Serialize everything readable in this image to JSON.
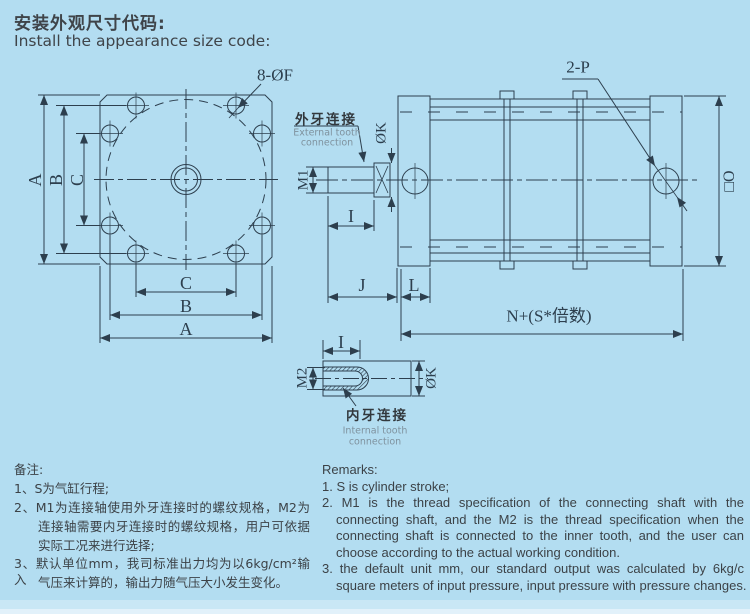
{
  "title": {
    "zh": "安装外观尺寸代码:",
    "en": "Install the appearance size code:"
  },
  "colors": {
    "background": "#b3ddf1",
    "line": "#2d3f4e",
    "text": "#3f4449",
    "muted": "#7f929e"
  },
  "front_view": {
    "dim_a": "A",
    "dim_b": "B",
    "dim_c": "C",
    "bolt_holes": "8-ØF"
  },
  "side_view": {
    "ports": "2-P",
    "square_size": "□O",
    "dim_j": "J",
    "dim_l": "L",
    "dim_i": "I",
    "total_length": "N+(S*倍数)",
    "thread_m1": "M1",
    "rod_dia": "ØK",
    "external_zh": "外牙连接",
    "external_en1": "External tooth",
    "external_en2": "connection"
  },
  "internal_view": {
    "dim_i": "I",
    "thread_m2": "M2",
    "dia_k": "ØK",
    "internal_zh": "内牙连接",
    "internal_en1": "Internal tooth",
    "internal_en2": "connection"
  },
  "remarks_zh": {
    "heading": "备注:",
    "line1": "1、S为气缸行程;",
    "line2": "2、M1为连接轴使用外牙连接时的螺纹规格，M2为",
    "line3": "连接轴需要内牙连接时的螺纹规格，用户可依据",
    "line4": "实际工况来进行选择;",
    "line5": "3、默认单位mm，我司标准出力均为以6kg/cm²输入",
    "line6": "气压来计算的，输出力随气压大小发生变化。"
  },
  "remarks_en": {
    "heading": "Remarks:",
    "line1": "1. S is cylinder stroke;",
    "line2": "2. M1 is the thread specification of the connecting shaft with the",
    "line3": "connecting shaft, and the M2 is the thread specification when the",
    "line4": "connecting shaft is connected to the inner tooth, and the user can",
    "line5": "choose according to the actual working condition.",
    "line6": "3. the default unit mm, our standard output was calculated by 6kg/c",
    "line7": "square meters of input pressure, input pressure with pressure changes."
  }
}
